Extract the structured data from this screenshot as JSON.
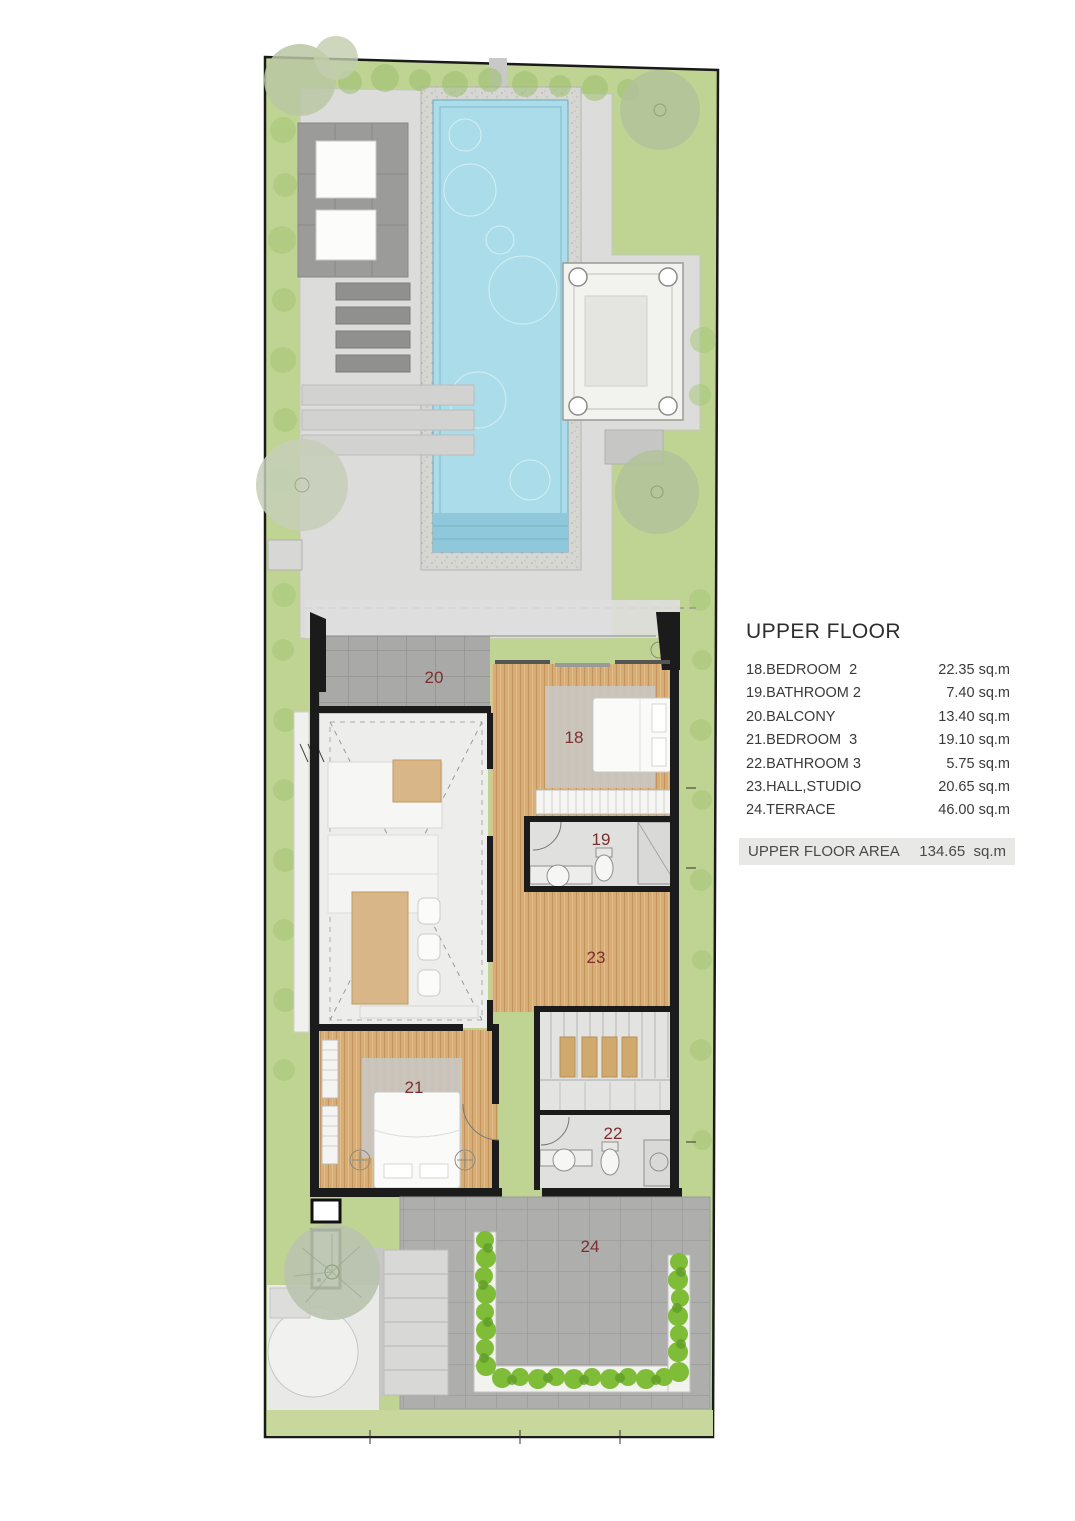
{
  "legend": {
    "title": "UPPER FLOOR",
    "rows": [
      {
        "name": "18.BEDROOM  2",
        "area": "22.35 sq.m"
      },
      {
        "name": "19.BATHROOM 2",
        "area": "7.40 sq.m"
      },
      {
        "name": "20.BALCONY",
        "area": "13.40 sq.m"
      },
      {
        "name": "21.BEDROOM  3",
        "area": "19.10 sq.m"
      },
      {
        "name": "22.BATHROOM 3",
        "area": "5.75 sq.m"
      },
      {
        "name": "23.HALL,STUDIO",
        "area": "20.65 sq.m"
      },
      {
        "name": "24.TERRACE",
        "area": "46.00 sq.m"
      }
    ],
    "total_label": "UPPER FLOOR AREA",
    "total_area": "134.65  sq.m"
  },
  "plan": {
    "room_labels": {
      "balcony": "20",
      "bedroom_2": "18",
      "bathroom_2": "19",
      "hall_studio": "23",
      "bedroom_3": "21",
      "bathroom_3": "22",
      "terrace": "24"
    },
    "colors": {
      "grass": "#bfd492",
      "pool_water": "#aadde9",
      "wood_floor": "#d7ad75",
      "balcony_tile": "#a9a9a7",
      "terrace_tile": "#aeaeac",
      "hedge_green": "#7fbc38",
      "wall_black": "#1b1b1b",
      "room_label_red": "#7d2f2f",
      "legend_bar_gray": "#e8e8e7"
    }
  }
}
